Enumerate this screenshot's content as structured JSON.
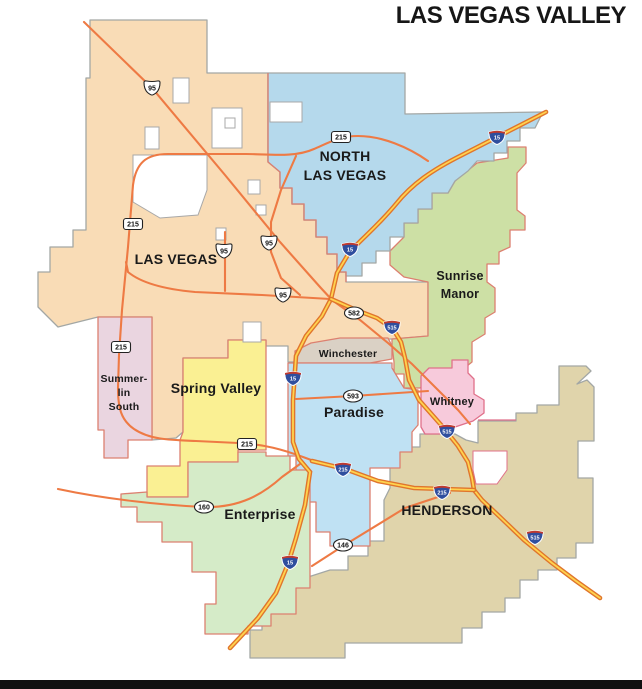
{
  "title": "LAS VEGAS VALLEY",
  "map": {
    "background": "#ffffff",
    "footer_bar_color": "#111111",
    "label_color": "#1a1a1a",
    "regions": [
      {
        "id": "las-vegas",
        "name": "Las Vegas",
        "fill": "#f9dcb6",
        "stroke": "#a3a7a5",
        "path": "M90,20 L207,20 L207,73 L268,73 L268,162 L280,172 L280,188 L292,188 L292,204 L304,204 L304,220 L316,220 L316,237 L327,237 L327,254 L337,254 L337,272 L346,272 L346,282 L428,282 L428,336 L392,339 L352,339 L312,344 L298,351 L298,362 L288,362 L288,346 L266,346 L266,340 L228,340 L228,358 L183,358 L183,432 L176,438 L152,440 L152,317 L98,317 L58,327 L38,307 L38,272 L50,272 L50,247 L73,247 L73,230 L86,230 L86,78 L90,78 Z"
      },
      {
        "id": "sunrise-manor",
        "name": "Sunrise Manor",
        "fill": "#cde0a5",
        "stroke": "#dc8070",
        "path": "M455,181 L477,163 L508,158 L508,147 L526,147 L526,163 L517,173 L517,210 L525,216 L525,230 L510,230 L510,247 L499,252 L499,264 L487,264 L487,282 L495,288 L495,312 L485,318 L485,334 L472,342 L472,362 L462,370 L448,373 L432,379 L420,388 L404,388 L404,374 L394,374 L394,362 L392,345 L392,339 L428,336 L428,282 L404,277 L390,265 L390,251 L404,237 L404,223 L418,223 L418,209 L432,209 L432,193 L448,193 Z"
      },
      {
        "id": "north-las-vegas",
        "name": "North Las Vegas",
        "fill": "#b5d9ec",
        "stroke": "#a3a7a5",
        "path": "M268,73 L405,73 L405,114 L543,112 L535,128 L520,128 L520,141 L507,141 L507,153 L494,153 L494,161 L477,161 L468,171 L455,181 L448,193 L432,193 L432,209 L418,209 L418,223 L404,223 L404,237 L390,237 L390,251 L376,251 L376,263 L362,263 L362,276 L346,276 L346,272 L337,272 L337,254 L327,254 L327,237 L316,237 L316,220 L304,220 L304,204 L292,204 L292,188 L280,188 L280,172 L268,162 Z"
      },
      {
        "id": "henderson",
        "name": "Henderson",
        "fill": "#e0d4ab",
        "stroke": "#a3a7a5",
        "path": "M393,447 L420,447 L420,434 L455,434 L466,440 L478,443 L478,421 L516,421 L516,413 L537,413 L537,405 L559,405 L559,366 L586,366 L591,371 L577,384 L587,380 L594,387 L594,441 L578,441 L578,478 L593,478 L593,543 L576,543 L576,558 L557,558 L557,570 L538,570 L538,580 L520,580 L520,598 L505,598 L505,612 L482,612 L482,628 L462,628 L462,643 L345,643 L345,658 L250,658 L250,630 L262,630 L262,604 L283,604 L305,578 L330,570 L348,570 L348,556 L368,556 L368,541 L384,541 L384,500 L390,488 L390,460 Z"
      },
      {
        "id": "winchester",
        "name": "Winchester",
        "fill": "#dad1c5",
        "stroke": "#dc8070",
        "path": "M295,351 L311,343 L340,338 L388,338 L392,346 L392,359 L370,363 L295,363 Z"
      },
      {
        "id": "paradise",
        "name": "Paradise",
        "fill": "#bfe1f3",
        "stroke": "#dc8070",
        "path": "M288,363 L392,363 L392,368 L404,388 L418,390 L418,425 L412,432 L412,452 L400,452 L400,468 L370,468 L370,546 L330,546 L330,532 L316,532 L316,502 L308,502 L308,472 L296,472 L296,456 L288,456 Z"
      },
      {
        "id": "whitney",
        "name": "Whitney",
        "fill": "#f7cadb",
        "stroke": "#e0708a",
        "path": "M421,376 L429,368 L452,368 L452,360 L468,360 L468,373 L474,379 L474,394 L484,400 L484,413 L473,421 L455,427 L449,434 L425,434 L421,427 Z"
      },
      {
        "id": "spring-valley",
        "name": "Spring Valley",
        "fill": "#faf093",
        "stroke": "#dc8070",
        "path": "M183,358 L228,358 L228,340 L266,340 L266,450 L238,450 L238,462 L188,462 L188,497 L147,497 L147,466 L180,466 L180,440 L183,432 Z"
      },
      {
        "id": "summerlin-south",
        "name": "Summerlin South",
        "fill": "#ead5e0",
        "stroke": "#dc8070",
        "path": "M98,317 L152,317 L152,440 L128,440 L128,458 L104,458 L104,430 L98,430 Z"
      },
      {
        "id": "enterprise",
        "name": "Enterprise",
        "fill": "#d5ebc8",
        "stroke": "#dc8070",
        "path": "M147,497 L188,497 L188,462 L238,462 L238,452 L266,452 L266,456 L290,456 L290,470 L310,470 L310,588 L296,588 L296,614 L271,614 L271,626 L248,626 L248,634 L205,634 L205,604 L216,604 L216,572 L192,572 L192,542 L162,542 L162,522 L137,522 L137,507 L121,507 L121,494 L147,492 Z"
      }
    ],
    "enclaves": [
      {
        "path": "M173,78 h16 v25 h-16 Z",
        "stroke": "#a8a8a8"
      },
      {
        "path": "M212,108 h30 v40 h-30 Z",
        "stroke": "#a8a8a8"
      },
      {
        "path": "M145,127 h14 v22 h-14 Z",
        "stroke": "#a8a8a8"
      },
      {
        "path": "M133,155 L207,155 L207,190 L198,215 L160,218 L133,202 Z",
        "stroke": "#a8a8a8"
      },
      {
        "path": "M225,118 h10 v10 h-10 Z",
        "stroke": "#a8a8a8"
      },
      {
        "path": "M248,180 h12 v14 h-12 Z",
        "stroke": "#a8a8a8"
      },
      {
        "path": "M256,205 h10 v10 h-10 Z",
        "stroke": "#a8a8a8"
      },
      {
        "path": "M216,228 h10 v12 h-10 Z",
        "stroke": "#a8a8a8"
      },
      {
        "path": "M243,322 h18 v20 h-18 Z",
        "stroke": "#a8a8a8"
      },
      {
        "path": "M270,102 h32 v20 h-32 Z",
        "stroke": "#a8a8a8"
      },
      {
        "path": "M473,451 L507,451 L507,470 L497,484 L476,484 L473,470 Z",
        "stroke": "#e0708a"
      }
    ],
    "borders": [
      {
        "name": "las-vegas-north-las-vegas-boundary",
        "color": "#dc7f70",
        "path": "M268,73 L268,162 L280,172 L280,188 L292,188 L292,204 L304,204 L304,220 L316,220 L316,237 L327,237 L327,254 L337,254 L337,272 L346,272 L346,282"
      },
      {
        "name": "whitney-east-boundary",
        "color": "#e0708a",
        "path": "M478,420 L516,420"
      }
    ],
    "roads": {
      "minor_color": "#ee7a44",
      "interstate_casing": "#e0752c",
      "interstate_core": "#ffd34f",
      "minor": [
        "M84,22 L152,88 L225,175 L280,242 L320,287 L332,300",
        "M332,300 L360,320 L388,343 L412,364 L436,388 L458,410 L470,424",
        "M428,161 C408,147 382,136 358,136 C340,136 330,142 314,149 C294,158 268,154 246,154 L168,154 C146,154 136,163 133,185 L128,247 L122,310 L119,355 L118,388 C118,408 121,420 134,429 C150,440 172,440 196,441 L238,443 C264,444 284,450 303,457 L314,461",
        "M126,262 L128,272 C140,282 162,289 195,292 L262,295 L330,299",
        "M296,156 L281,190 L271,222 L271,252 L281,278 L300,295",
        "M225,232 L225,291",
        "M296,399 L353,396 L428,391",
        "M58,489 C105,499 160,505 204,507 C240,508 263,494 282,477 L300,464",
        "M312,566 L343,546 L405,508 L450,493"
      ],
      "interstate": [
        "M546,112 L462,155 C432,170 412,184 396,204 C376,228 360,240 349,253 L337,273 L331,299 L322,316 L306,336 L296,356 L293,400 L293,442 L299,459 L310,472 L305,505 L296,538 L288,564 L276,593 L258,618 L230,648",
        "M331,299 L356,310 L377,318 L393,329 L401,342 L405,358 L409,380 L419,400 L442,426 L458,446 L468,462 L472,478 L474,490 L482,500 L500,517 L524,540 L552,563 L576,581 L600,598",
        "M312,461 L345,469 L378,481 L414,488 L474,490"
      ]
    },
    "shields": [
      {
        "type": "us",
        "label": "95",
        "x": 152,
        "y": 88
      },
      {
        "type": "us",
        "label": "95",
        "x": 224,
        "y": 251
      },
      {
        "type": "us",
        "label": "95",
        "x": 269,
        "y": 243
      },
      {
        "type": "us",
        "label": "95",
        "x": 283,
        "y": 295
      },
      {
        "type": "cc",
        "label": "215",
        "x": 341,
        "y": 137
      },
      {
        "type": "cc",
        "label": "215",
        "x": 133,
        "y": 224
      },
      {
        "type": "cc",
        "label": "215",
        "x": 121,
        "y": 347
      },
      {
        "type": "cc",
        "label": "215",
        "x": 247,
        "y": 444
      },
      {
        "type": "sr",
        "label": "582",
        "x": 354,
        "y": 313
      },
      {
        "type": "sr",
        "label": "593",
        "x": 353,
        "y": 396
      },
      {
        "type": "sr",
        "label": "160",
        "x": 204,
        "y": 507
      },
      {
        "type": "sr",
        "label": "146",
        "x": 343,
        "y": 545
      },
      {
        "type": "interstate",
        "label": "15",
        "x": 497,
        "y": 137
      },
      {
        "type": "interstate",
        "label": "15",
        "x": 350,
        "y": 249
      },
      {
        "type": "interstate",
        "label": "15",
        "x": 293,
        "y": 378
      },
      {
        "type": "interstate",
        "label": "15",
        "x": 290,
        "y": 562
      },
      {
        "type": "interstate",
        "label": "515",
        "x": 392,
        "y": 327
      },
      {
        "type": "interstate",
        "label": "515",
        "x": 447,
        "y": 431
      },
      {
        "type": "interstate",
        "label": "515",
        "x": 535,
        "y": 537
      },
      {
        "type": "interstate",
        "label": "215",
        "x": 343,
        "y": 469
      },
      {
        "type": "interstate",
        "label": "215",
        "x": 442,
        "y": 492
      }
    ],
    "labels": [
      {
        "id": "north-las-vegas-1",
        "text": "NORTH",
        "x": 345,
        "y": 161,
        "size": 14
      },
      {
        "id": "north-las-vegas-2",
        "text": "LAS VEGAS",
        "x": 345,
        "y": 180,
        "size": 14
      },
      {
        "id": "las-vegas",
        "text": "LAS VEGAS",
        "x": 176,
        "y": 264,
        "size": 14
      },
      {
        "id": "sunrise-manor-1",
        "text": "Sunrise",
        "x": 460,
        "y": 280,
        "size": 12.5
      },
      {
        "id": "sunrise-manor-2",
        "text": "Manor",
        "x": 460,
        "y": 298,
        "size": 12.5
      },
      {
        "id": "winchester",
        "text": "Winchester",
        "x": 348,
        "y": 357,
        "size": 10.5
      },
      {
        "id": "paradise",
        "text": "Paradise",
        "x": 354,
        "y": 417,
        "size": 14
      },
      {
        "id": "whitney",
        "text": "Whitney",
        "x": 452,
        "y": 405,
        "size": 11
      },
      {
        "id": "spring-valley",
        "text": "Spring Valley",
        "x": 216,
        "y": 393,
        "size": 14
      },
      {
        "id": "summerlin-south-1",
        "text": "Summer-",
        "x": 124,
        "y": 382,
        "size": 10.5
      },
      {
        "id": "summerlin-south-2",
        "text": "lin",
        "x": 124,
        "y": 396,
        "size": 10.5
      },
      {
        "id": "summerlin-south-3",
        "text": "South",
        "x": 124,
        "y": 410,
        "size": 10.5
      },
      {
        "id": "enterprise",
        "text": "Enterprise",
        "x": 260,
        "y": 519,
        "size": 14
      },
      {
        "id": "henderson",
        "text": "HENDERSON",
        "x": 447,
        "y": 515,
        "size": 14
      }
    ]
  }
}
